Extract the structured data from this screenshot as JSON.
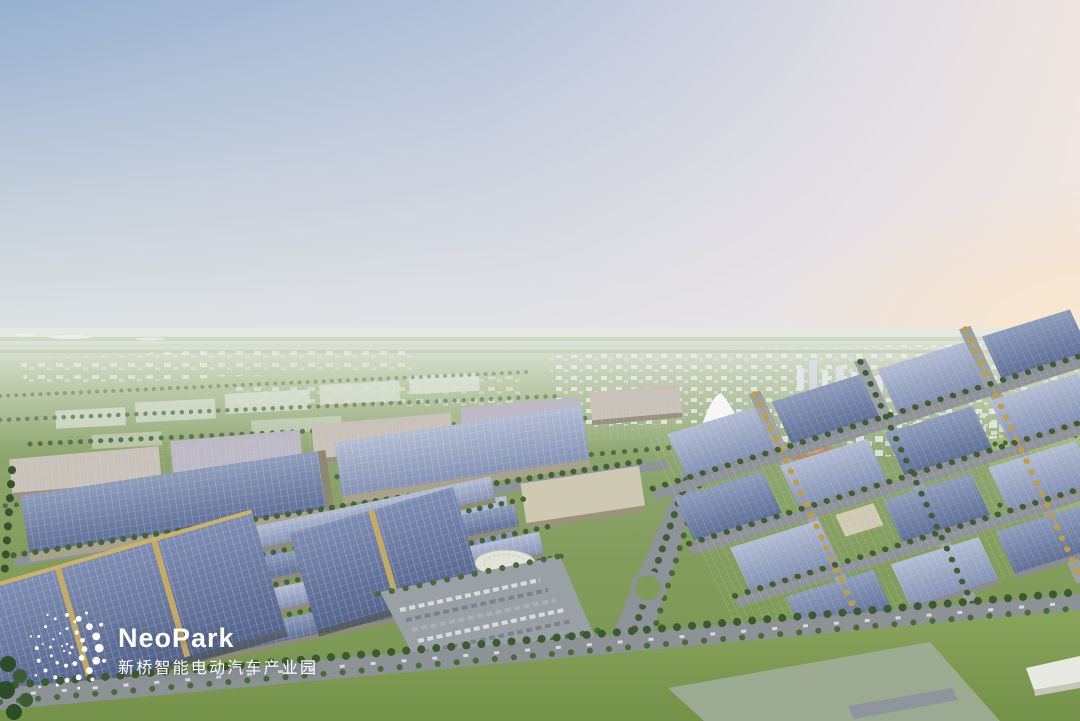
{
  "branding": {
    "name": "NeoPark",
    "subtitle": "新桥智能电动汽车产业园",
    "text_color": "#ffffff",
    "logo_mark_icon": "dot-swirl-constellation"
  },
  "palette": {
    "sky_top_left": "#97b0d0",
    "sky_top_right": "#e9e3ea",
    "sunset_glow": "#f7e6cf",
    "distant_plain": "#a9b98e",
    "parkland_green": "#7f9b58",
    "solar_roof_blue": "#6b7da6",
    "building_beige": "#cfc8b2",
    "road_gray": "#8e9399",
    "tree_green": "#3f5e33",
    "autumn_tree_yellow": "#bf9e44"
  }
}
